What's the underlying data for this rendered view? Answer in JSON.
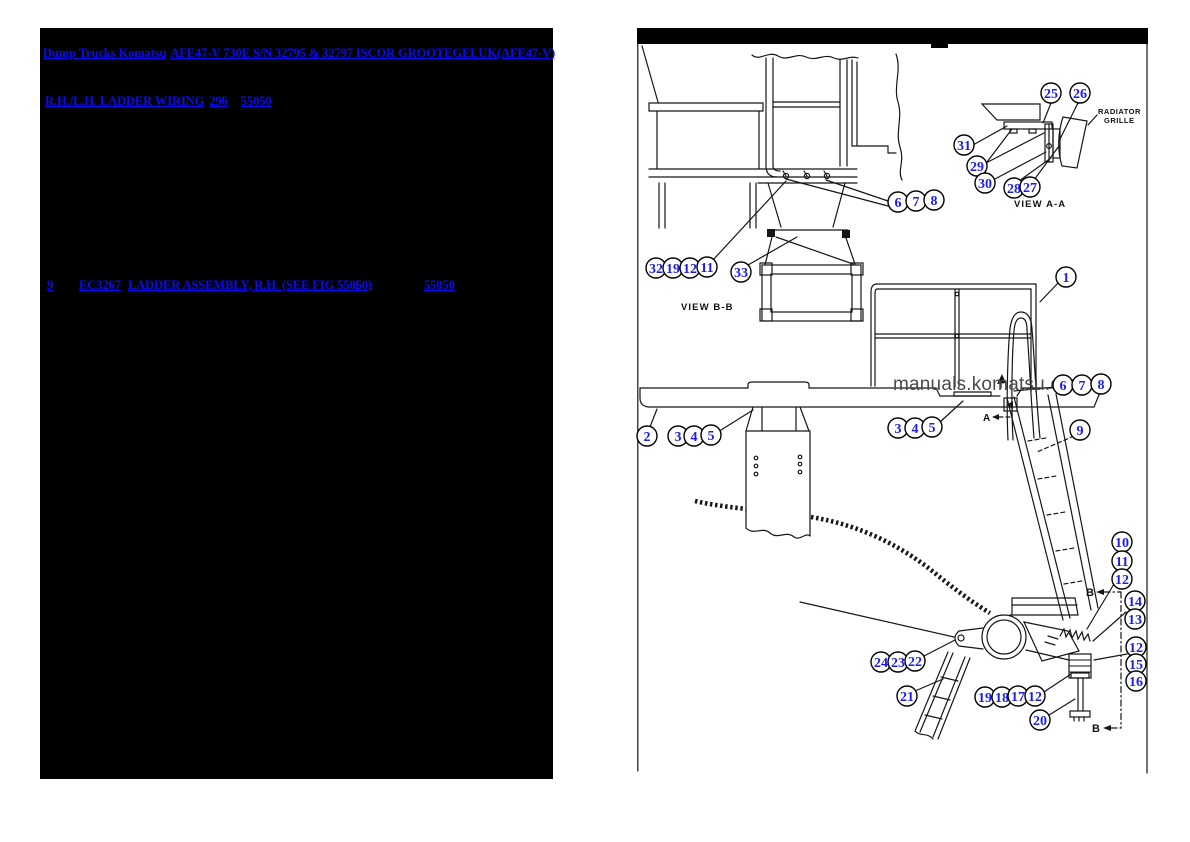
{
  "colors": {
    "link": "#0b0bee",
    "callout": "#1d1de4",
    "wm": "#4a4a4a",
    "panel_bg": "#000000"
  },
  "left_panel": {
    "title_link_1": "Dump Trucks Komatsu",
    "title_link_2": "AFE47-V 730E S/N 32795 & 32797 ISCOR GROOTEGELUK(AFE47-V)",
    "subtitle_link": "R.H./L.H. LADDER WIRING",
    "subtitle_page": "296",
    "subtitle_fig": "55050",
    "row": {
      "item": "9",
      "part_no": "EC3267",
      "description": "LADDER ASSEMBLY, R.H. (SEE FIG 55050)",
      "qty": "1",
      "fig": "55050"
    }
  },
  "diagram": {
    "watermark": "manuals.komatsu.com",
    "labels": {
      "view_aa": "VIEW A-A",
      "view_bb": "VIEW B-B",
      "radiator_1": "RADIATOR",
      "radiator_2": "GRILLE",
      "section_b": "B",
      "section_a": "A"
    },
    "callouts": [
      {
        "label": "6"
      },
      {
        "label": "7"
      },
      {
        "label": "8"
      },
      {
        "label": "32"
      },
      {
        "label": "19"
      },
      {
        "label": "12"
      },
      {
        "label": "11"
      },
      {
        "label": "33"
      },
      {
        "label": "25"
      },
      {
        "label": "26"
      },
      {
        "label": "31"
      },
      {
        "label": "29"
      },
      {
        "label": "30"
      },
      {
        "label": "28"
      },
      {
        "label": "27"
      },
      {
        "label": "1"
      },
      {
        "label": "6"
      },
      {
        "label": "7"
      },
      {
        "label": "8"
      },
      {
        "label": "2"
      },
      {
        "label": "3"
      },
      {
        "label": "4"
      },
      {
        "label": "5"
      },
      {
        "label": "3"
      },
      {
        "label": "4"
      },
      {
        "label": "5"
      },
      {
        "label": "9"
      },
      {
        "label": "10"
      },
      {
        "label": "11"
      },
      {
        "label": "12"
      },
      {
        "label": "14"
      },
      {
        "label": "13"
      },
      {
        "label": "12"
      },
      {
        "label": "15"
      },
      {
        "label": "16"
      },
      {
        "label": "24"
      },
      {
        "label": "23"
      },
      {
        "label": "22"
      },
      {
        "label": "21"
      },
      {
        "label": "19"
      },
      {
        "label": "18"
      },
      {
        "label": "17"
      },
      {
        "label": "12"
      },
      {
        "label": "20"
      }
    ]
  }
}
